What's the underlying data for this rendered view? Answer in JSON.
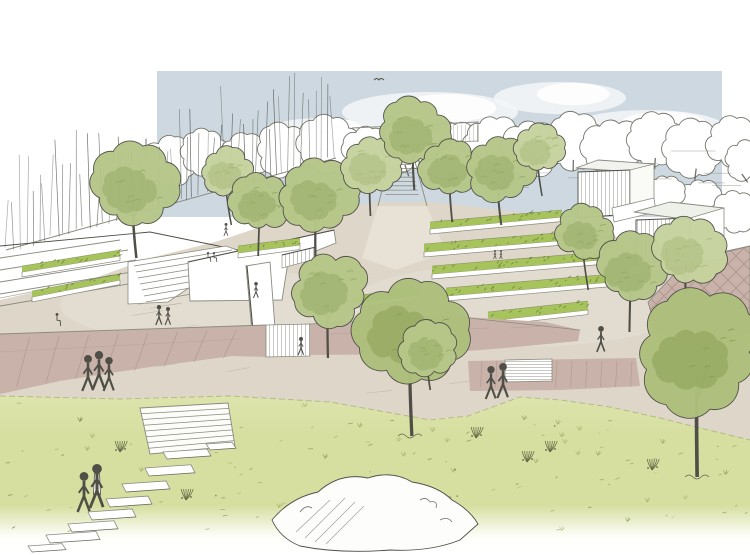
{
  "scene": {
    "type": "architectural landscape perspective sketch",
    "style": "pen line work with watercolor wash",
    "subject": "terraced park plaza with tree bosque, stepped planters, pavilions and meadow foreground"
  },
  "colors": {
    "paper": "#ffffff",
    "ink": "#4f4f48",
    "ink_light": "#8b8b80",
    "sky": "#cdd8e1",
    "cloud": "#f3f5f7",
    "plaza": "#ded6c8",
    "plaza_light": "#eae4d8",
    "mauve": "#c8b2a9",
    "mauve_light": "#dac9c1",
    "joint": "#a68d83",
    "shrub": "#a7c45c",
    "shrub_dark": "#6f813c",
    "grass_top": "#dde4ad",
    "grass": "#d6dfa0",
    "grass_fade": "#fdfdf8",
    "grass_deep": "#93a15a",
    "foliage_light": "#c6d39e",
    "foliage_light_dark": "#a7b878",
    "foliage_mid": "#b6c789",
    "foliage_mid_dark": "#93a861",
    "foliage_front": "#aec07c",
    "foliage_front_dark": "#879b50"
  },
  "sky_rect": {
    "x": 157,
    "y": 71,
    "w": 565,
    "h": 146
  },
  "clouds": [
    {
      "x": 430,
      "y": 112,
      "rx": 88,
      "ry": 20
    },
    {
      "x": 560,
      "y": 98,
      "rx": 66,
      "ry": 16
    },
    {
      "x": 648,
      "y": 128,
      "rx": 78,
      "ry": 18
    },
    {
      "x": 320,
      "y": 132,
      "rx": 55,
      "ry": 14
    },
    {
      "x": 500,
      "y": 140,
      "rx": 70,
      "ry": 15
    }
  ],
  "background_canopies": [
    {
      "x": 170,
      "y": 162,
      "r": 26
    },
    {
      "x": 205,
      "y": 152,
      "r": 23
    },
    {
      "x": 242,
      "y": 160,
      "r": 25
    },
    {
      "x": 284,
      "y": 150,
      "r": 27
    },
    {
      "x": 328,
      "y": 144,
      "r": 29
    },
    {
      "x": 368,
      "y": 152,
      "r": 25
    },
    {
      "x": 408,
      "y": 146,
      "r": 27
    },
    {
      "x": 450,
      "y": 150,
      "r": 29
    },
    {
      "x": 492,
      "y": 143,
      "r": 27
    },
    {
      "x": 532,
      "y": 149,
      "r": 29
    },
    {
      "x": 574,
      "y": 141,
      "r": 27
    },
    {
      "x": 614,
      "y": 149,
      "r": 29
    },
    {
      "x": 654,
      "y": 139,
      "r": 27
    },
    {
      "x": 694,
      "y": 149,
      "r": 28
    },
    {
      "x": 732,
      "y": 143,
      "r": 24
    },
    {
      "x": 746,
      "y": 160,
      "r": 20
    },
    {
      "x": 700,
      "y": 200,
      "r": 22
    },
    {
      "x": 736,
      "y": 212,
      "r": 22
    },
    {
      "x": 664,
      "y": 192,
      "r": 18
    }
  ],
  "reed_screen": {
    "x1": 6,
    "y1": 250,
    "x2": 334,
    "y2": 158,
    "count": 52,
    "h_min": 45,
    "h_max": 100
  },
  "planting_strips": [
    {
      "x1": 430,
      "y1": 222,
      "x2": 562,
      "y2": 210,
      "w": 7
    },
    {
      "x1": 424,
      "y1": 244,
      "x2": 580,
      "y2": 231,
      "w": 8
    },
    {
      "x1": 432,
      "y1": 266,
      "x2": 600,
      "y2": 252,
      "w": 8
    },
    {
      "x1": 446,
      "y1": 288,
      "x2": 612,
      "y2": 274,
      "w": 8
    },
    {
      "x1": 238,
      "y1": 246,
      "x2": 300,
      "y2": 238,
      "w": 7
    },
    {
      "x1": 22,
      "y1": 266,
      "x2": 120,
      "y2": 250,
      "w": 6
    },
    {
      "x1": 32,
      "y1": 291,
      "x2": 120,
      "y2": 274,
      "w": 6
    },
    {
      "x1": 488,
      "y1": 312,
      "x2": 588,
      "y2": 301,
      "w": 9
    },
    {
      "x1": 352,
      "y1": 296,
      "x2": 420,
      "y2": 288,
      "w": 7
    }
  ],
  "trees_midground": [
    {
      "x": 135,
      "y": 186,
      "r": 40,
      "ground": 258,
      "tone": "mid"
    },
    {
      "x": 228,
      "y": 172,
      "r": 24,
      "ground": 225,
      "tone": "light"
    },
    {
      "x": 262,
      "y": 202,
      "r": 28,
      "ground": 256,
      "tone": "mid"
    },
    {
      "x": 318,
      "y": 196,
      "r": 36,
      "ground": 260,
      "tone": "mid"
    },
    {
      "x": 372,
      "y": 166,
      "r": 28,
      "ground": 216,
      "tone": "light"
    },
    {
      "x": 415,
      "y": 132,
      "r": 33,
      "ground": 190,
      "tone": "mid"
    },
    {
      "x": 452,
      "y": 168,
      "r": 29,
      "ground": 222,
      "tone": "mid"
    },
    {
      "x": 500,
      "y": 168,
      "r": 32,
      "ground": 225,
      "tone": "mid"
    },
    {
      "x": 540,
      "y": 148,
      "r": 24,
      "ground": 196,
      "tone": "light"
    },
    {
      "x": 585,
      "y": 232,
      "r": 26,
      "ground": 290,
      "tone": "mid"
    },
    {
      "x": 633,
      "y": 268,
      "r": 33,
      "ground": 332,
      "tone": "mid"
    },
    {
      "x": 688,
      "y": 252,
      "r": 33,
      "ground": 300,
      "tone": "light"
    },
    {
      "x": 330,
      "y": 290,
      "r": 36,
      "ground": 358,
      "tone": "mid"
    }
  ],
  "trees_foreground": [
    {
      "x": 412,
      "y": 330,
      "r": 52,
      "ground": 436,
      "tone": "front"
    },
    {
      "x": 430,
      "y": 350,
      "r": 27,
      "ground": 390,
      "tone": "mid"
    },
    {
      "x": 699,
      "y": 352,
      "r": 58,
      "ground": 477,
      "tone": "front"
    }
  ],
  "people_mid": [
    {
      "x": 88,
      "y": 391,
      "h": 36
    },
    {
      "x": 99,
      "y": 389,
      "h": 38
    },
    {
      "x": 109,
      "y": 391,
      "h": 34
    },
    {
      "x": 159,
      "y": 325,
      "h": 20
    },
    {
      "x": 168,
      "y": 325,
      "h": 18
    },
    {
      "x": 57,
      "y": 326,
      "h": 13,
      "v": "sit"
    },
    {
      "x": 256,
      "y": 298,
      "h": 16
    },
    {
      "x": 226,
      "y": 236,
      "h": 13
    },
    {
      "x": 208,
      "y": 262,
      "h": 10,
      "v": "sit"
    },
    {
      "x": 214,
      "y": 262,
      "h": 10,
      "v": "sit"
    },
    {
      "x": 301,
      "y": 355,
      "h": 18
    },
    {
      "x": 491,
      "y": 399,
      "h": 33
    },
    {
      "x": 503,
      "y": 398,
      "h": 35
    },
    {
      "x": 601,
      "y": 352,
      "h": 26
    },
    {
      "x": 495,
      "y": 259,
      "h": 9
    },
    {
      "x": 501,
      "y": 259,
      "h": 9
    }
  ],
  "people_foreground": [
    {
      "x": 84,
      "y": 512,
      "h": 40
    },
    {
      "x": 97,
      "y": 508,
      "h": 44,
      "v": "coat"
    }
  ],
  "stepping_stones": [
    {
      "x": 163,
      "y": 452,
      "w": 44,
      "h": 7
    },
    {
      "x": 145,
      "y": 468,
      "w": 46,
      "h": 8
    },
    {
      "x": 122,
      "y": 484,
      "w": 44,
      "h": 8
    },
    {
      "x": 106,
      "y": 499,
      "w": 42,
      "h": 8
    },
    {
      "x": 88,
      "y": 512,
      "w": 44,
      "h": 8
    },
    {
      "x": 68,
      "y": 524,
      "w": 46,
      "h": 8
    },
    {
      "x": 46,
      "y": 535,
      "w": 50,
      "h": 8
    },
    {
      "x": 206,
      "y": 444,
      "w": 26,
      "h": 6
    },
    {
      "x": 28,
      "y": 546,
      "w": 34,
      "h": 6
    }
  ],
  "grass_clusters": [
    {
      "x": 186,
      "y": 500
    },
    {
      "x": 527,
      "y": 462
    },
    {
      "x": 550,
      "y": 452
    },
    {
      "x": 476,
      "y": 438
    },
    {
      "x": 302,
      "y": 524
    },
    {
      "x": 652,
      "y": 470
    },
    {
      "x": 120,
      "y": 452
    }
  ],
  "grass_edge": [
    [
      0,
      396
    ],
    [
      120,
      399
    ],
    [
      230,
      396
    ],
    [
      330,
      402
    ],
    [
      430,
      420
    ],
    [
      468,
      416
    ],
    [
      520,
      397
    ],
    [
      560,
      400
    ],
    [
      610,
      407
    ],
    [
      660,
      418
    ],
    [
      700,
      428
    ],
    [
      750,
      440
    ]
  ]
}
